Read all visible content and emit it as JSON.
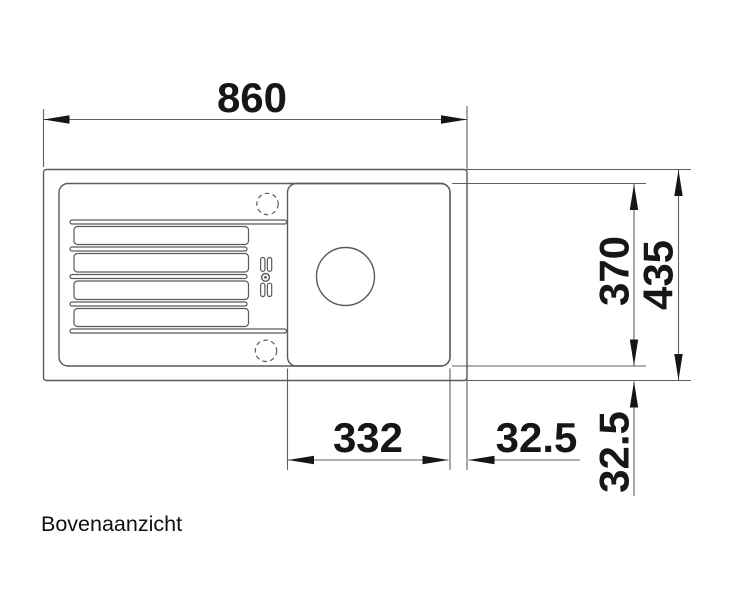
{
  "caption": "Bovenaanzicht",
  "dimensions": {
    "overall_length": "860",
    "inner_width": "370",
    "overall_width": "435",
    "bowl_length": "332",
    "edge_offset_horizontal": "32.5",
    "edge_offset_vertical": "32.5"
  },
  "colors": {
    "background": "#ffffff",
    "drawing_line": "#5a5a5a",
    "dimension_line": "#5f5f5f",
    "text": "#161616"
  }
}
